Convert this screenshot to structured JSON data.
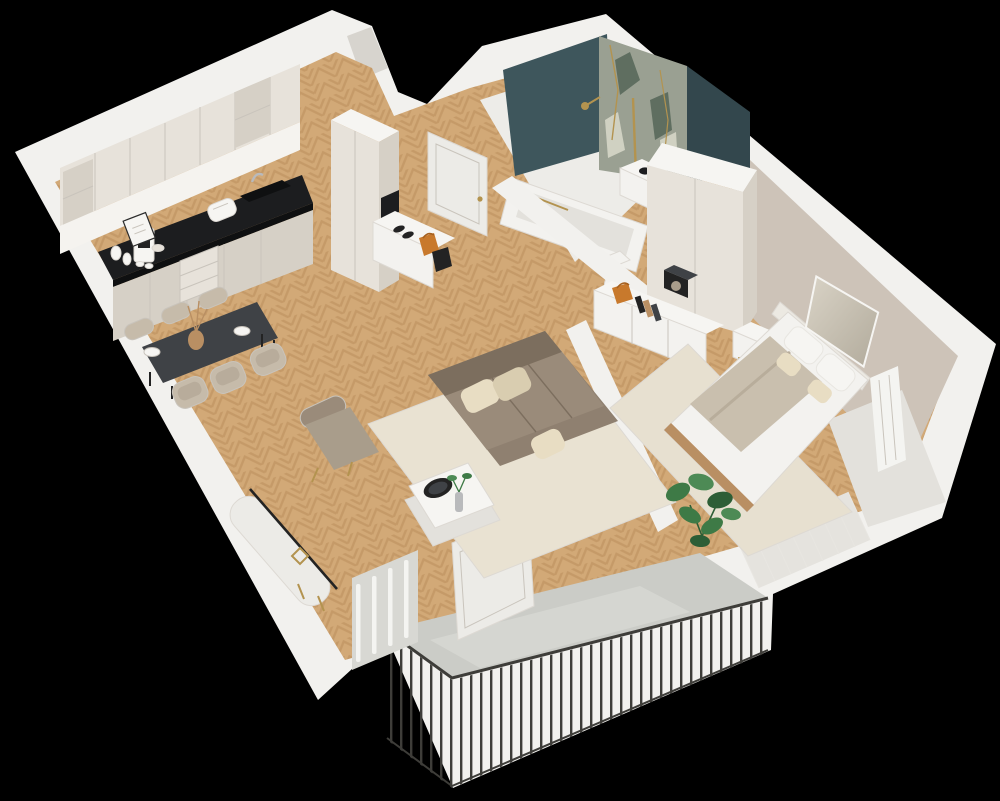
{
  "scene": {
    "title": "3D isometric cutaway floor plan of a one-bedroom apartment",
    "style": "photoreal isometric render on black background"
  },
  "palette": {
    "bg": "#000000",
    "wall": "#f2f1ee",
    "wall_shade": "#e3e1dc",
    "wall_dark": "#d7d4ce",
    "wood_base": "#d2a977",
    "wood_dark": "#b88c5a",
    "tile": "#edece8",
    "concrete": "#cbccc7",
    "concrete_light": "#d8d9d4",
    "railing": "#3e3d39",
    "teal": "#3e565c",
    "teal_deep": "#33474d",
    "marble": "#9aa092",
    "marble_dark": "#5f6e60",
    "marble_light": "#d0d1c2",
    "gold": "#b3934f",
    "counter": "#1c1d1f",
    "counter_edge": "#0f1011",
    "cabinet": "#e7e2da",
    "cabinet_shade": "#d6d0c6",
    "cabinet_dark": "#cdc6bb",
    "splash": "#f5f3ef",
    "table_top": "#3f4246",
    "chair": "#c6bbaa",
    "chair_dark": "#a99d8b",
    "sofa": "#8f8070",
    "sofa_dark": "#7c6e5e",
    "sofa_light": "#9a8b7a",
    "pillow": "#e8ddc3",
    "pillow_dark": "#d9cdb0",
    "rug": "#e9e2d2",
    "rug_bedroom": "#e7e0d0",
    "bed_white": "#f3f2ef",
    "headboard": "#ece9e2",
    "blanket": "#c9bfae",
    "blanket_dark": "#b8ad9b",
    "wood_frame": "#b98f63",
    "plant": "#3e7a46",
    "plant_dark": "#2d5e36",
    "plant_light": "#4d8a55",
    "door": "#ecebe7",
    "greige": "#cdc3b8",
    "mirror_light": "#d9d3c6",
    "mirror_dark": "#b2ab9c",
    "orange": "#c8792c",
    "orange_dark": "#a5601f",
    "near_black": "#232323",
    "chrome": "#b9babc",
    "curtain": "#f4f4f1",
    "curtain_shade": "#d8d8d3",
    "white_soft": "#f6f5f2",
    "radiator": "#e5e3de"
  },
  "rooms": {
    "kitchen": {
      "label": "kitchen",
      "items": [
        "upper cabinets",
        "open shelves",
        "range hood",
        "backsplash",
        "black countertop",
        "sink",
        "faucet",
        "coffee machine",
        "toaster",
        "picture frame",
        "canisters",
        "base cabinets",
        "drawer unit",
        "tall cabinet"
      ]
    },
    "dining": {
      "label": "dining area",
      "items": [
        "dark stone dining table",
        "six upholstered chairs",
        "vase with dried branches",
        "two plates"
      ]
    },
    "living": {
      "label": "living room",
      "items": [
        "three-seat taupe sofa",
        "cream cushions",
        "two-tier coffee table",
        "decorative tray",
        "vase with greenery",
        "velvet armchair",
        "cream rug",
        "console table with gold legs",
        "curtains",
        "balcony door"
      ]
    },
    "hallway": {
      "label": "hallway",
      "items": [
        "entry door",
        "shoe console",
        "shoes",
        "orange handbag",
        "sideboard",
        "books",
        "dark storage box"
      ]
    },
    "bathroom": {
      "label": "bathroom",
      "items": [
        "bathtub",
        "gold shower set",
        "green marble accent panel",
        "teal walls",
        "vanity with sink",
        "toilet"
      ]
    },
    "bedroom": {
      "label": "bedroom",
      "items": [
        "double bed",
        "white pillows",
        "taupe throw blanket",
        "nightstand",
        "wardrobe",
        "leaning mirror",
        "monstera plant",
        "cream rug",
        "slatted radiator",
        "window recess",
        "curtain"
      ]
    },
    "balcony": {
      "label": "balcony",
      "items": [
        "concrete floor",
        "dark metal railing"
      ]
    }
  }
}
